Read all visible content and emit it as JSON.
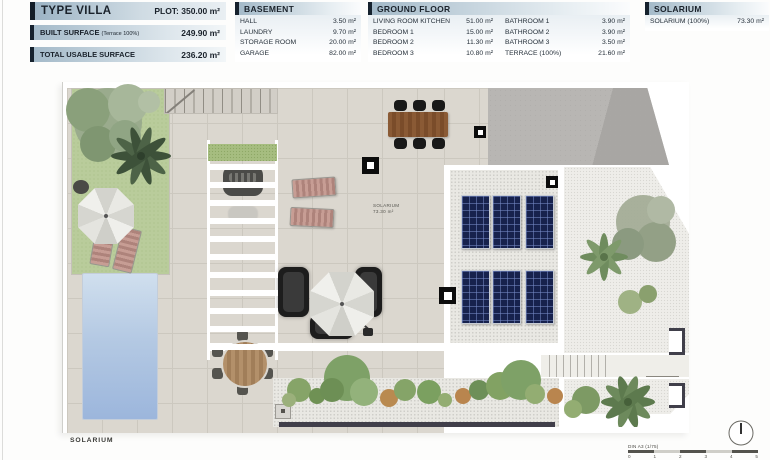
{
  "header": {
    "type_villa": {
      "title": "TYPE VILLA",
      "plot": "PLOT: 350.00 m²"
    },
    "built_surface": {
      "label": "BUILT SURFACE",
      "sublabel": "(Terrace 100%)",
      "value": "249.90 m²"
    },
    "total_usable": {
      "label": "TOTAL USABLE SURFACE",
      "value": "236.20 m²"
    },
    "basement": {
      "title": "BASEMENT",
      "rows": [
        {
          "label": "HALL",
          "value": "3.50 m²"
        },
        {
          "label": "LAUNDRY",
          "value": "9.70 m²"
        },
        {
          "label": "STORAGE ROOM",
          "value": "20.00 m²"
        },
        {
          "label": "GARAGE",
          "value": "82.00 m²"
        }
      ]
    },
    "ground_floor": {
      "title": "GROUND FLOOR",
      "col1": [
        {
          "label": "LIVING ROOM KITCHEN",
          "value": "51.00 m²"
        },
        {
          "label": "BEDROOM 1",
          "value": "15.00 m²"
        },
        {
          "label": "BEDROOM 2",
          "value": "11.30 m²"
        },
        {
          "label": "BEDROOM 3",
          "value": "10.80 m²"
        }
      ],
      "col2": [
        {
          "label": "BATHROOM 1",
          "value": "3.90 m²"
        },
        {
          "label": "BATHROOM 2",
          "value": "3.90 m²"
        },
        {
          "label": "BATHROOM 3",
          "value": "3.50 m²"
        },
        {
          "label": "TERRACE (100%)",
          "value": "21.60 m²"
        }
      ]
    },
    "solarium": {
      "title": "SOLARIUM",
      "rows": [
        {
          "label": "SOLARIUM (100%)",
          "value": "73.30 m²"
        }
      ]
    }
  },
  "plan": {
    "room_label": {
      "name": "SOLARIUM",
      "area": "73.30 m²"
    },
    "bottom_caption": "SOLARIUM",
    "scale": {
      "label": "DIN A3 (1/75)",
      "ticks": [
        "0",
        "1",
        "2",
        "3",
        "4",
        "5"
      ]
    }
  },
  "colors": {
    "accent_dark": "#16222e",
    "header_gradient_start": "#a4bac9",
    "lawn_green": "#b9cc9b",
    "pool_blue": "#9cb6dc",
    "solar_panel_navy": "#17224d",
    "table_wood": "#8a5a35",
    "wall_dark": "#413f4a"
  }
}
